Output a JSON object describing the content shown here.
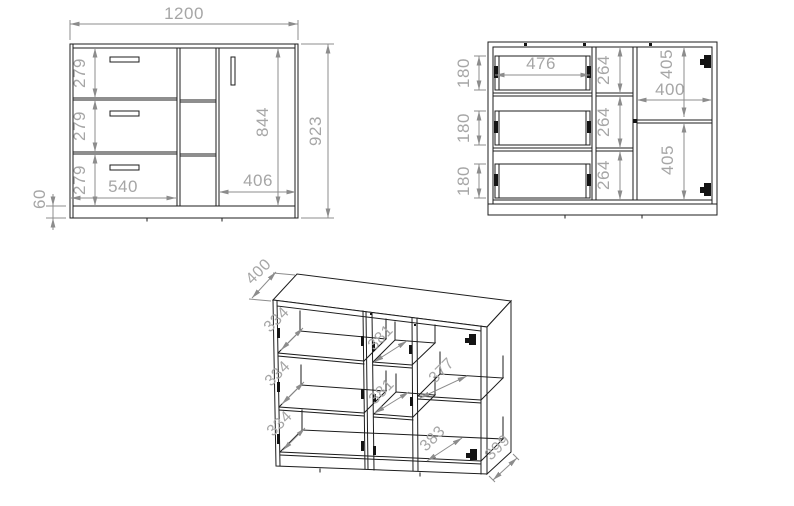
{
  "meta": {
    "background_color": "#ffffff",
    "line_color": "#1d1d1d",
    "dimension_line_color": "#8c8c8c",
    "dimension_text_color": "#a6a6a6"
  },
  "front": {
    "total_width": "1200",
    "total_height": "923",
    "door_height": "844",
    "door_width": "406",
    "drawer_front_width": "540",
    "drawer_front_height_1": "279",
    "drawer_front_height_2": "279",
    "drawer_front_height_3": "279",
    "plinth_height": "60"
  },
  "internal": {
    "drawer_box_height_1": "180",
    "drawer_box_height_2": "180",
    "drawer_box_height_3": "180",
    "drawer_box_width": "476",
    "middle_opening_1": "264",
    "middle_opening_2": "264",
    "middle_opening_3": "264",
    "right_section_width": "400",
    "right_opening_top": "405",
    "right_opening_bottom": "405"
  },
  "isometric": {
    "top_depth": "400",
    "compartment_depth_1": "334",
    "compartment_depth_2": "334",
    "compartment_depth_3": "334",
    "middle_shelf_depth_1": "381",
    "middle_shelf_depth_2": "381",
    "right_shelf_depth": "377",
    "right_bottom_depth": "383",
    "side_depth": "399"
  }
}
